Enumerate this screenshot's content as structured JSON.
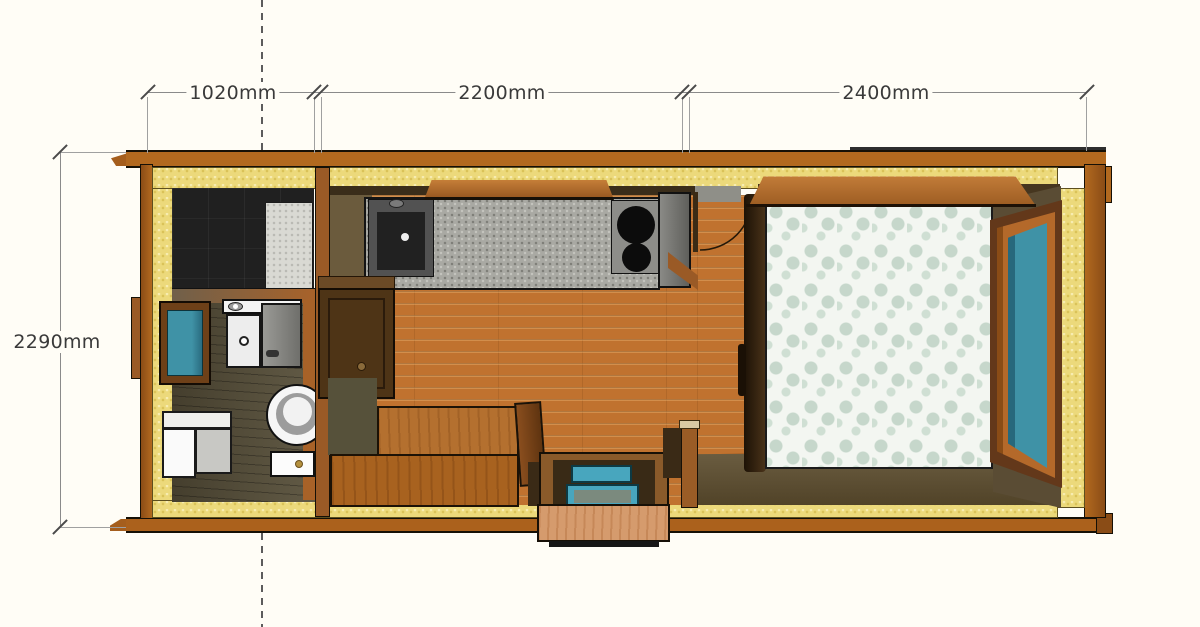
{
  "diagram": {
    "type": "tiny-house-floor-plan-top-view",
    "dimensions": {
      "top": [
        {
          "label": "1020mm",
          "span": "bathroom-width"
        },
        {
          "label": "2200mm",
          "span": "kitchen-living-width"
        },
        {
          "label": "2400mm",
          "span": "bedroom-width"
        }
      ],
      "left": {
        "label": "2290mm",
        "span": "overall-depth"
      }
    },
    "fixtures": [
      "shower",
      "shower-tray",
      "bathroom-window",
      "vanity-sink",
      "vanity-cabinet",
      "toilet",
      "storage-box",
      "kitchen-counter",
      "kitchen-sink",
      "cooktop",
      "overhead-shelf",
      "wall-cabinet",
      "interior-door",
      "bench-back",
      "bench-seat",
      "entry-door",
      "entry-step",
      "bed",
      "headboard-shelf",
      "bedroom-window"
    ],
    "colors": {
      "cladding": "#b2691f",
      "insulation": "#ecd97b",
      "floor_planks": "#c0722f",
      "floor_dark": "#58503a",
      "countertop": "#a9a9a3",
      "glass": "#3f92a6",
      "duvet_base": "#f3f6f1",
      "duvet_pattern": "#c6d7cb",
      "dimension_line": "#8a8a8a",
      "dimension_text": "#3a3a3a"
    }
  }
}
